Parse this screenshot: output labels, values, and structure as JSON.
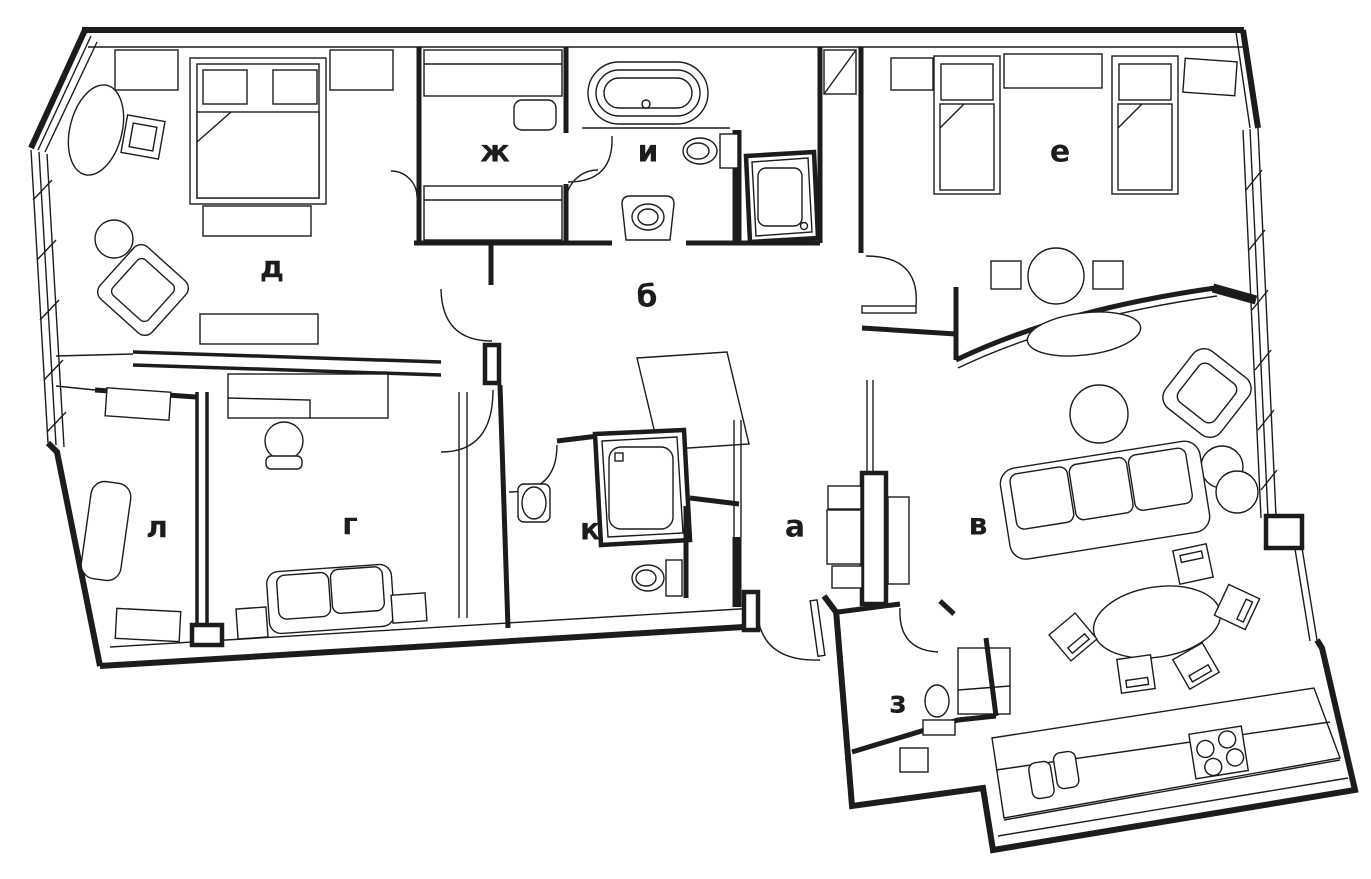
{
  "plan": {
    "type": "apartment-floor-plan",
    "colors": {
      "line": "#1c1c1c",
      "background": "#ffffff"
    },
    "rooms": [
      {
        "id": "a",
        "label": "а",
        "x": 795,
        "y": 527
      },
      {
        "id": "b",
        "label": "б",
        "x": 647,
        "y": 297
      },
      {
        "id": "v",
        "label": "в",
        "x": 978,
        "y": 525
      },
      {
        "id": "g",
        "label": "г",
        "x": 350,
        "y": 525
      },
      {
        "id": "d",
        "label": "д",
        "x": 272,
        "y": 268
      },
      {
        "id": "e",
        "label": "е",
        "x": 1060,
        "y": 152
      },
      {
        "id": "zh",
        "label": "ж",
        "x": 495,
        "y": 152
      },
      {
        "id": "z",
        "label": "з",
        "x": 898,
        "y": 703
      },
      {
        "id": "i",
        "label": "и",
        "x": 648,
        "y": 152
      },
      {
        "id": "k",
        "label": "к",
        "x": 590,
        "y": 530
      },
      {
        "id": "l",
        "label": "л",
        "x": 157,
        "y": 528
      }
    ]
  }
}
